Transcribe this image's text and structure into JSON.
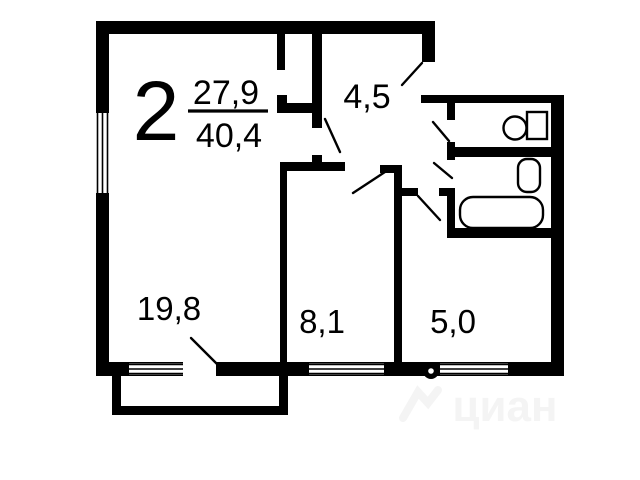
{
  "plan": {
    "rooms_count": "2",
    "area_living": "27,9",
    "area_total": "40,4",
    "rooms": [
      {
        "name": "hallway",
        "area": "4,5"
      },
      {
        "name": "living-room",
        "area": "19,8"
      },
      {
        "name": "bedroom",
        "area": "8,1"
      },
      {
        "name": "kitchen",
        "area": "5,0"
      }
    ],
    "fixtures": [
      "toilet-icon",
      "sink-icon",
      "bathtub-icon",
      "vent-icon"
    ],
    "watermark": "циан",
    "colors": {
      "ink": "#000000",
      "background": "#ffffff",
      "watermark": "#f4f4f4"
    }
  }
}
